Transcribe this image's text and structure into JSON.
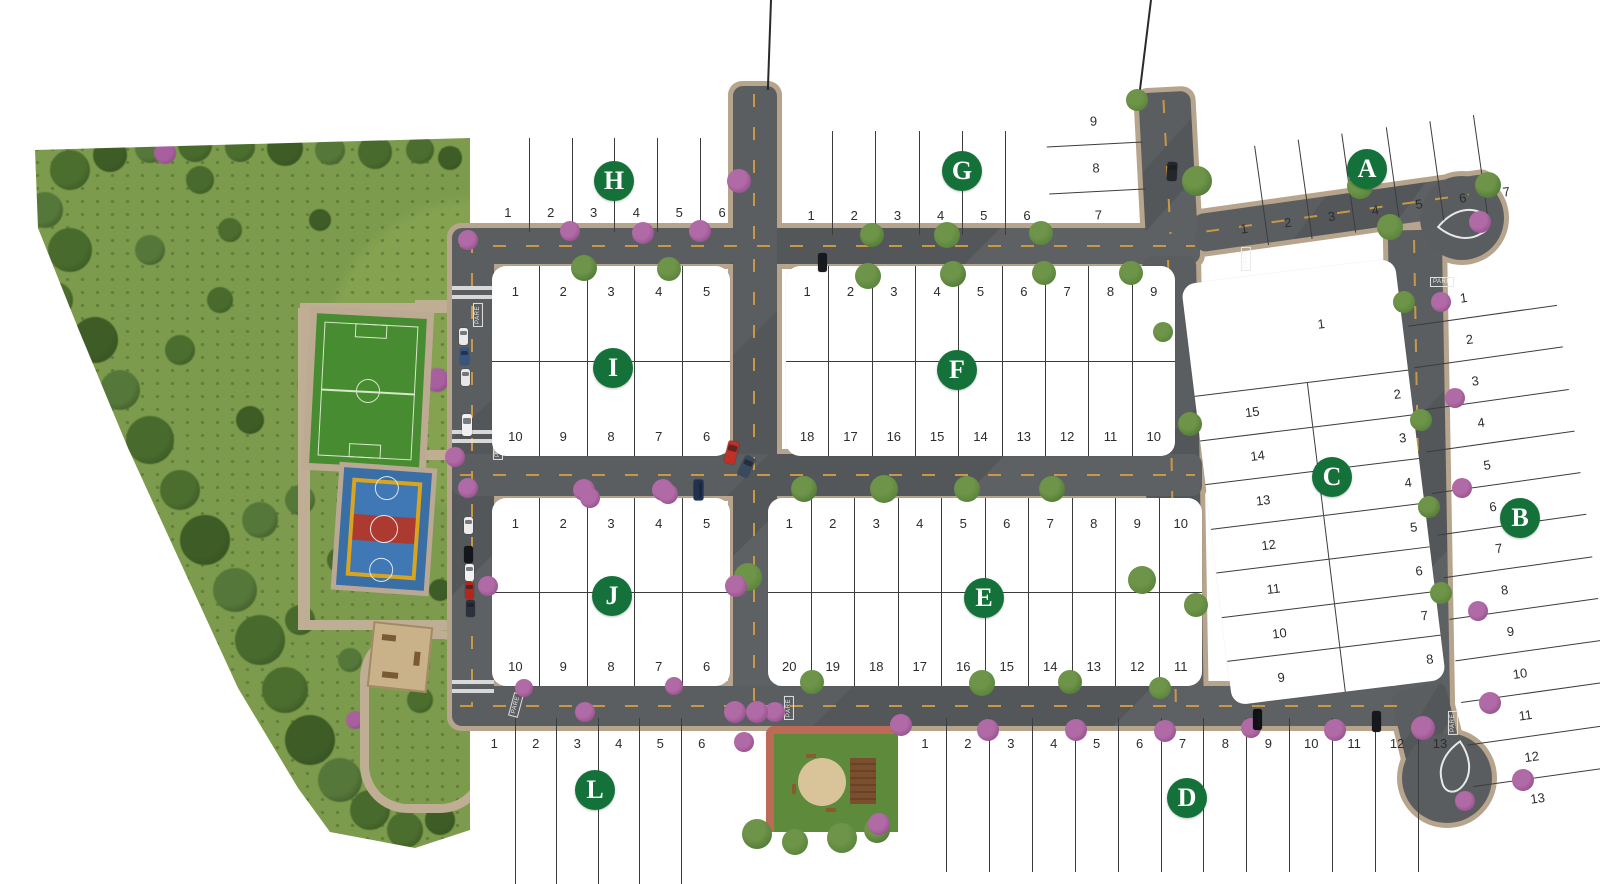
{
  "title": "Residential lot map with blocks A-L",
  "badge_color": "#14713a",
  "road_marking_label": "PARE",
  "blocks": [
    {
      "letter": "H",
      "kind": "grid",
      "box": [
        487,
        138,
        256,
        94
      ],
      "rot": 0,
      "pad": false,
      "badge": [
        614,
        181
      ],
      "rows": [
        {
          "align": "bottom",
          "lots": [
            "1",
            "2",
            "3",
            "4",
            "5",
            "6"
          ]
        }
      ]
    },
    {
      "letter": "G",
      "kind": "grid",
      "box": [
        790,
        131,
        258,
        104
      ],
      "rot": 0,
      "pad": false,
      "badge": [
        962,
        171
      ],
      "rows": [
        {
          "align": "bottom",
          "lots": [
            "1",
            "2",
            "3",
            "4",
            "5",
            "6"
          ]
        }
      ]
    },
    {
      "letter": "G-annex",
      "kind": "stack",
      "box": [
        1048,
        98,
        96,
        140
      ],
      "rot": -3,
      "pad": false,
      "lots": [
        "9",
        "8",
        "7"
      ]
    },
    {
      "letter": "A",
      "kind": "grid",
      "box": [
        1217,
        130,
        308,
        100
      ],
      "rot": -8,
      "pad": false,
      "badge": [
        1367,
        169
      ],
      "rows": [
        {
          "align": "bottom",
          "lots": [
            "1",
            "2",
            "3",
            "4",
            "5",
            "6",
            "7"
          ]
        }
      ]
    },
    {
      "letter": "I",
      "kind": "grid",
      "box": [
        492,
        266,
        238,
        190
      ],
      "rot": 0,
      "pad": true,
      "badge": [
        613,
        368
      ],
      "rows": [
        {
          "align": "top",
          "lots": [
            "1",
            "2",
            "3",
            "4",
            "5"
          ]
        },
        {
          "align": "bottom",
          "lots": [
            "10",
            "9",
            "8",
            "7",
            "6"
          ]
        }
      ]
    },
    {
      "letter": "F",
      "kind": "grid",
      "box": [
        786,
        266,
        389,
        190
      ],
      "rot": 0,
      "pad": true,
      "badge": [
        957,
        370
      ],
      "rows": [
        {
          "align": "top",
          "lots": [
            "1",
            "2",
            "3",
            "4",
            "5",
            "6",
            "7",
            "8",
            "9"
          ]
        },
        {
          "align": "bottom",
          "lots": [
            "18",
            "17",
            "16",
            "15",
            "14",
            "13",
            "12",
            "11",
            "10"
          ]
        }
      ]
    },
    {
      "letter": "J",
      "kind": "grid",
      "box": [
        492,
        498,
        238,
        188
      ],
      "rot": 0,
      "pad": true,
      "badge": [
        612,
        596
      ],
      "rows": [
        {
          "align": "top",
          "lots": [
            "1",
            "2",
            "3",
            "4",
            "5"
          ]
        },
        {
          "align": "bottom",
          "lots": [
            "10",
            "9",
            "8",
            "7",
            "6"
          ]
        }
      ]
    },
    {
      "letter": "E",
      "kind": "grid",
      "box": [
        768,
        498,
        434,
        188
      ],
      "rot": 0,
      "pad": true,
      "badge": [
        984,
        598
      ],
      "rows": [
        {
          "align": "top",
          "lots": [
            "1",
            "2",
            "3",
            "4",
            "5",
            "6",
            "7",
            "8",
            "9",
            "10"
          ]
        },
        {
          "align": "bottom",
          "lots": [
            "20",
            "19",
            "18",
            "17",
            "16",
            "15",
            "14",
            "13",
            "12",
            "11"
          ]
        }
      ]
    },
    {
      "letter": "L",
      "kind": "grid",
      "box": [
        474,
        718,
        248,
        166
      ],
      "rot": 0,
      "pad": false,
      "badge": [
        595,
        790
      ],
      "rows": [
        {
          "align": "top",
          "lots": [
            "1",
            "2",
            "3",
            "4",
            "5",
            "6"
          ]
        }
      ]
    },
    {
      "letter": "D",
      "kind": "grid",
      "box": [
        904,
        718,
        557,
        154
      ],
      "rot": 0,
      "pad": false,
      "badge": [
        1187,
        798
      ],
      "rows": [
        {
          "align": "top",
          "lots": [
            "1",
            "2",
            "3",
            "4",
            "5",
            "6",
            "7",
            "8",
            "9",
            "10",
            "11",
            "12",
            "13"
          ]
        }
      ]
    },
    {
      "letter": "C",
      "kind": "cblock",
      "box": [
        1206,
        270,
        215,
        424
      ],
      "rot": -7,
      "pad": true,
      "badge": [
        1332,
        477
      ],
      "top_lot": "1",
      "left_col": [
        "15",
        "14",
        "13",
        "12",
        "11",
        "10",
        "9"
      ],
      "right_col": [
        "2",
        "3",
        "4",
        "5",
        "6",
        "7",
        "8"
      ]
    },
    {
      "letter": "B",
      "kind": "column",
      "box": [
        1440,
        272,
        150,
        548
      ],
      "rot": -8,
      "pad": false,
      "badge": [
        1520,
        518
      ],
      "lots": [
        "1",
        "2",
        "3",
        "4",
        "5",
        "6",
        "7",
        "8",
        "9",
        "10",
        "11",
        "12",
        "13"
      ]
    }
  ],
  "roads": {
    "segments": [
      [
        452,
        228,
        748,
        36,
        0
      ],
      [
        1193,
        194,
        300,
        38,
        -8
      ],
      [
        452,
        230,
        42,
        480,
        0
      ],
      [
        733,
        86,
        44,
        628,
        0
      ],
      [
        1142,
        92,
        52,
        146,
        -3
      ],
      [
        1146,
        256,
        54,
        456,
        -1
      ],
      [
        452,
        454,
        750,
        42,
        0
      ],
      [
        452,
        686,
        962,
        40,
        0
      ],
      [
        1392,
        230,
        54,
        482,
        -1
      ],
      [
        1398,
        686,
        56,
        76,
        -14
      ]
    ],
    "bulbs": [
      [
        1462,
        218,
        42
      ],
      [
        1447,
        778,
        45
      ]
    ],
    "dashes_h": [
      [
        460,
        245,
        735,
        0
      ],
      [
        1205,
        212,
        265,
        -8
      ],
      [
        460,
        474,
        735,
        0
      ],
      [
        460,
        705,
        945,
        0
      ]
    ],
    "dashes_v": [
      [
        471,
        240,
        465,
        0
      ],
      [
        753,
        94,
        612,
        0
      ],
      [
        1166,
        100,
        134,
        -3
      ],
      [
        1171,
        260,
        446,
        -1
      ],
      [
        1417,
        240,
        452,
        -1
      ]
    ],
    "crosswalks": [
      [
        452,
        286,
        42,
        16
      ],
      [
        452,
        430,
        42,
        16
      ],
      [
        452,
        680,
        42,
        16
      ]
    ],
    "pare": [
      [
        466,
        310,
        -90
      ],
      [
        486,
        443,
        -90
      ],
      [
        504,
        700,
        -75
      ],
      [
        777,
        703,
        -90
      ],
      [
        1234,
        254,
        -90
      ],
      [
        1430,
        277,
        0
      ],
      [
        1441,
        718,
        -90
      ]
    ],
    "entry_lines": [
      [
        770,
        0,
        90,
        2
      ],
      [
        1150,
        0,
        97,
        7
      ]
    ]
  },
  "facilities": {
    "soccer_field": {
      "x": 313,
      "y": 316,
      "w": 110,
      "h": 150,
      "rot": 3
    },
    "sports_court": {
      "x": 340,
      "y": 470,
      "w": 88,
      "h": 118,
      "rot": 4
    },
    "playground_square": {
      "x": 370,
      "y": 624,
      "w": 56,
      "h": 62,
      "rot": 6
    },
    "mini_park": {
      "x": 766,
      "y": 726,
      "w": 132,
      "h": 106
    },
    "park_paths": [
      [
        300,
        303,
        158,
        10
      ],
      [
        298,
        308,
        12,
        322
      ],
      [
        300,
        620,
        162,
        10
      ],
      [
        415,
        300,
        45,
        10
      ],
      [
        415,
        450,
        45,
        10
      ]
    ],
    "loop_ring": [
      360,
      630,
      110,
      165
    ]
  },
  "vegetation": {
    "park_trees": [
      [
        70,
        170,
        40
      ],
      [
        110,
        155,
        34
      ],
      [
        150,
        148,
        30
      ],
      [
        195,
        145,
        34
      ],
      [
        240,
        147,
        30
      ],
      [
        285,
        148,
        36
      ],
      [
        330,
        150,
        30
      ],
      [
        375,
        152,
        34
      ],
      [
        420,
        150,
        28
      ],
      [
        450,
        158,
        24
      ],
      [
        45,
        210,
        36
      ],
      [
        70,
        250,
        44
      ],
      [
        55,
        300,
        36
      ],
      [
        95,
        340,
        46
      ],
      [
        120,
        390,
        40
      ],
      [
        150,
        440,
        48
      ],
      [
        180,
        490,
        40
      ],
      [
        205,
        540,
        50
      ],
      [
        235,
        590,
        44
      ],
      [
        260,
        640,
        50
      ],
      [
        285,
        690,
        46
      ],
      [
        310,
        740,
        50
      ],
      [
        340,
        780,
        44
      ],
      [
        370,
        810,
        40
      ],
      [
        405,
        830,
        36
      ],
      [
        440,
        820,
        30
      ],
      [
        150,
        250,
        30
      ],
      [
        220,
        300,
        26
      ],
      [
        180,
        350,
        30
      ],
      [
        250,
        420,
        28
      ],
      [
        300,
        500,
        30
      ],
      [
        340,
        560,
        26
      ],
      [
        230,
        230,
        24
      ],
      [
        320,
        220,
        22
      ],
      [
        260,
        520,
        36
      ],
      [
        300,
        620,
        30
      ],
      [
        420,
        700,
        26
      ],
      [
        440,
        590,
        22
      ],
      [
        350,
        660,
        24
      ],
      [
        200,
        180,
        28
      ]
    ],
    "park_bushes": [
      [
        165,
        153,
        22
      ],
      [
        310,
        385,
        26
      ],
      [
        437,
        380,
        24
      ],
      [
        90,
        505,
        20
      ],
      [
        395,
        585,
        18
      ],
      [
        420,
        665,
        20
      ],
      [
        355,
        720,
        18
      ],
      [
        460,
        243,
        22
      ]
    ],
    "street_trees": [
      [
        584,
        268,
        26
      ],
      [
        669,
        269,
        24
      ],
      [
        868,
        276,
        26
      ],
      [
        953,
        274,
        26
      ],
      [
        1044,
        273,
        24
      ],
      [
        1131,
        273,
        24
      ],
      [
        872,
        235,
        24
      ],
      [
        947,
        235,
        26
      ],
      [
        1041,
        233,
        24
      ],
      [
        1197,
        181,
        30
      ],
      [
        1360,
        186,
        26
      ],
      [
        1390,
        227,
        26
      ],
      [
        804,
        489,
        26
      ],
      [
        884,
        489,
        28
      ],
      [
        967,
        489,
        26
      ],
      [
        1052,
        489,
        26
      ],
      [
        748,
        577,
        28
      ],
      [
        1142,
        580,
        28
      ],
      [
        1190,
        424,
        24
      ],
      [
        812,
        682,
        24
      ],
      [
        982,
        683,
        26
      ],
      [
        1070,
        682,
        24
      ],
      [
        1404,
        302,
        22
      ],
      [
        1421,
        420,
        22
      ],
      [
        1429,
        507,
        22
      ],
      [
        1441,
        593,
        22
      ],
      [
        1160,
        688,
        22
      ],
      [
        1488,
        185,
        26
      ],
      [
        1163,
        332,
        20
      ],
      [
        1196,
        605,
        24
      ],
      [
        757,
        834,
        30
      ],
      [
        795,
        842,
        26
      ],
      [
        842,
        838,
        30
      ],
      [
        877,
        830,
        26
      ],
      [
        1137,
        100,
        22
      ]
    ],
    "street_bushes": [
      [
        739,
        181,
        24
      ],
      [
        570,
        231,
        20
      ],
      [
        643,
        233,
        22
      ],
      [
        700,
        231,
        22
      ],
      [
        468,
        240,
        20
      ],
      [
        455,
        457,
        20
      ],
      [
        468,
        488,
        20
      ],
      [
        584,
        490,
        22
      ],
      [
        663,
        490,
        22
      ],
      [
        736,
        586,
        22
      ],
      [
        488,
        586,
        20
      ],
      [
        590,
        498,
        20
      ],
      [
        668,
        494,
        20
      ],
      [
        524,
        688,
        18
      ],
      [
        674,
        686,
        18
      ],
      [
        735,
        712,
        22
      ],
      [
        775,
        712,
        20
      ],
      [
        901,
        725,
        22
      ],
      [
        988,
        730,
        22
      ],
      [
        1076,
        730,
        22
      ],
      [
        1165,
        731,
        22
      ],
      [
        1251,
        728,
        20
      ],
      [
        1335,
        730,
        22
      ],
      [
        1423,
        728,
        24
      ],
      [
        1441,
        302,
        20
      ],
      [
        1455,
        398,
        20
      ],
      [
        1462,
        488,
        20
      ],
      [
        1478,
        611,
        20
      ],
      [
        1490,
        703,
        22
      ],
      [
        1523,
        780,
        22
      ],
      [
        1465,
        801,
        20
      ],
      [
        1480,
        222,
        22
      ],
      [
        744,
        742,
        20
      ],
      [
        879,
        824,
        22
      ],
      [
        757,
        712,
        22
      ],
      [
        585,
        712,
        20
      ]
    ]
  },
  "cars": [
    [
      459,
      328,
      9,
      17,
      "#e9e9e9",
      0
    ],
    [
      460,
      348,
      9,
      17,
      "#36557f",
      0
    ],
    [
      461,
      369,
      9,
      17,
      "#e6e6e6",
      0
    ],
    [
      462,
      414,
      10,
      22,
      "#f0f0f0",
      0
    ],
    [
      464,
      517,
      9,
      17,
      "#ececec",
      0
    ],
    [
      464,
      546,
      9,
      17,
      "#15161a",
      0
    ],
    [
      465,
      564,
      9,
      17,
      "#f1f1f1",
      0
    ],
    [
      465,
      582,
      9,
      17,
      "#b3261e",
      0
    ],
    [
      466,
      600,
      9,
      17,
      "#2c313b",
      0
    ],
    [
      726,
      441,
      11,
      23,
      "#c03026",
      14
    ],
    [
      741,
      456,
      11,
      21,
      "#3a4a5e",
      26
    ],
    [
      688,
      485,
      21,
      10,
      "#20324f",
      90
    ],
    [
      813,
      258,
      19,
      9,
      "#17191d",
      90
    ],
    [
      1167,
      162,
      10,
      19,
      "#23262b",
      3
    ],
    [
      1247,
      715,
      21,
      9,
      "#101114",
      90
    ],
    [
      1366,
      717,
      21,
      9,
      "#17181c",
      90
    ]
  ]
}
